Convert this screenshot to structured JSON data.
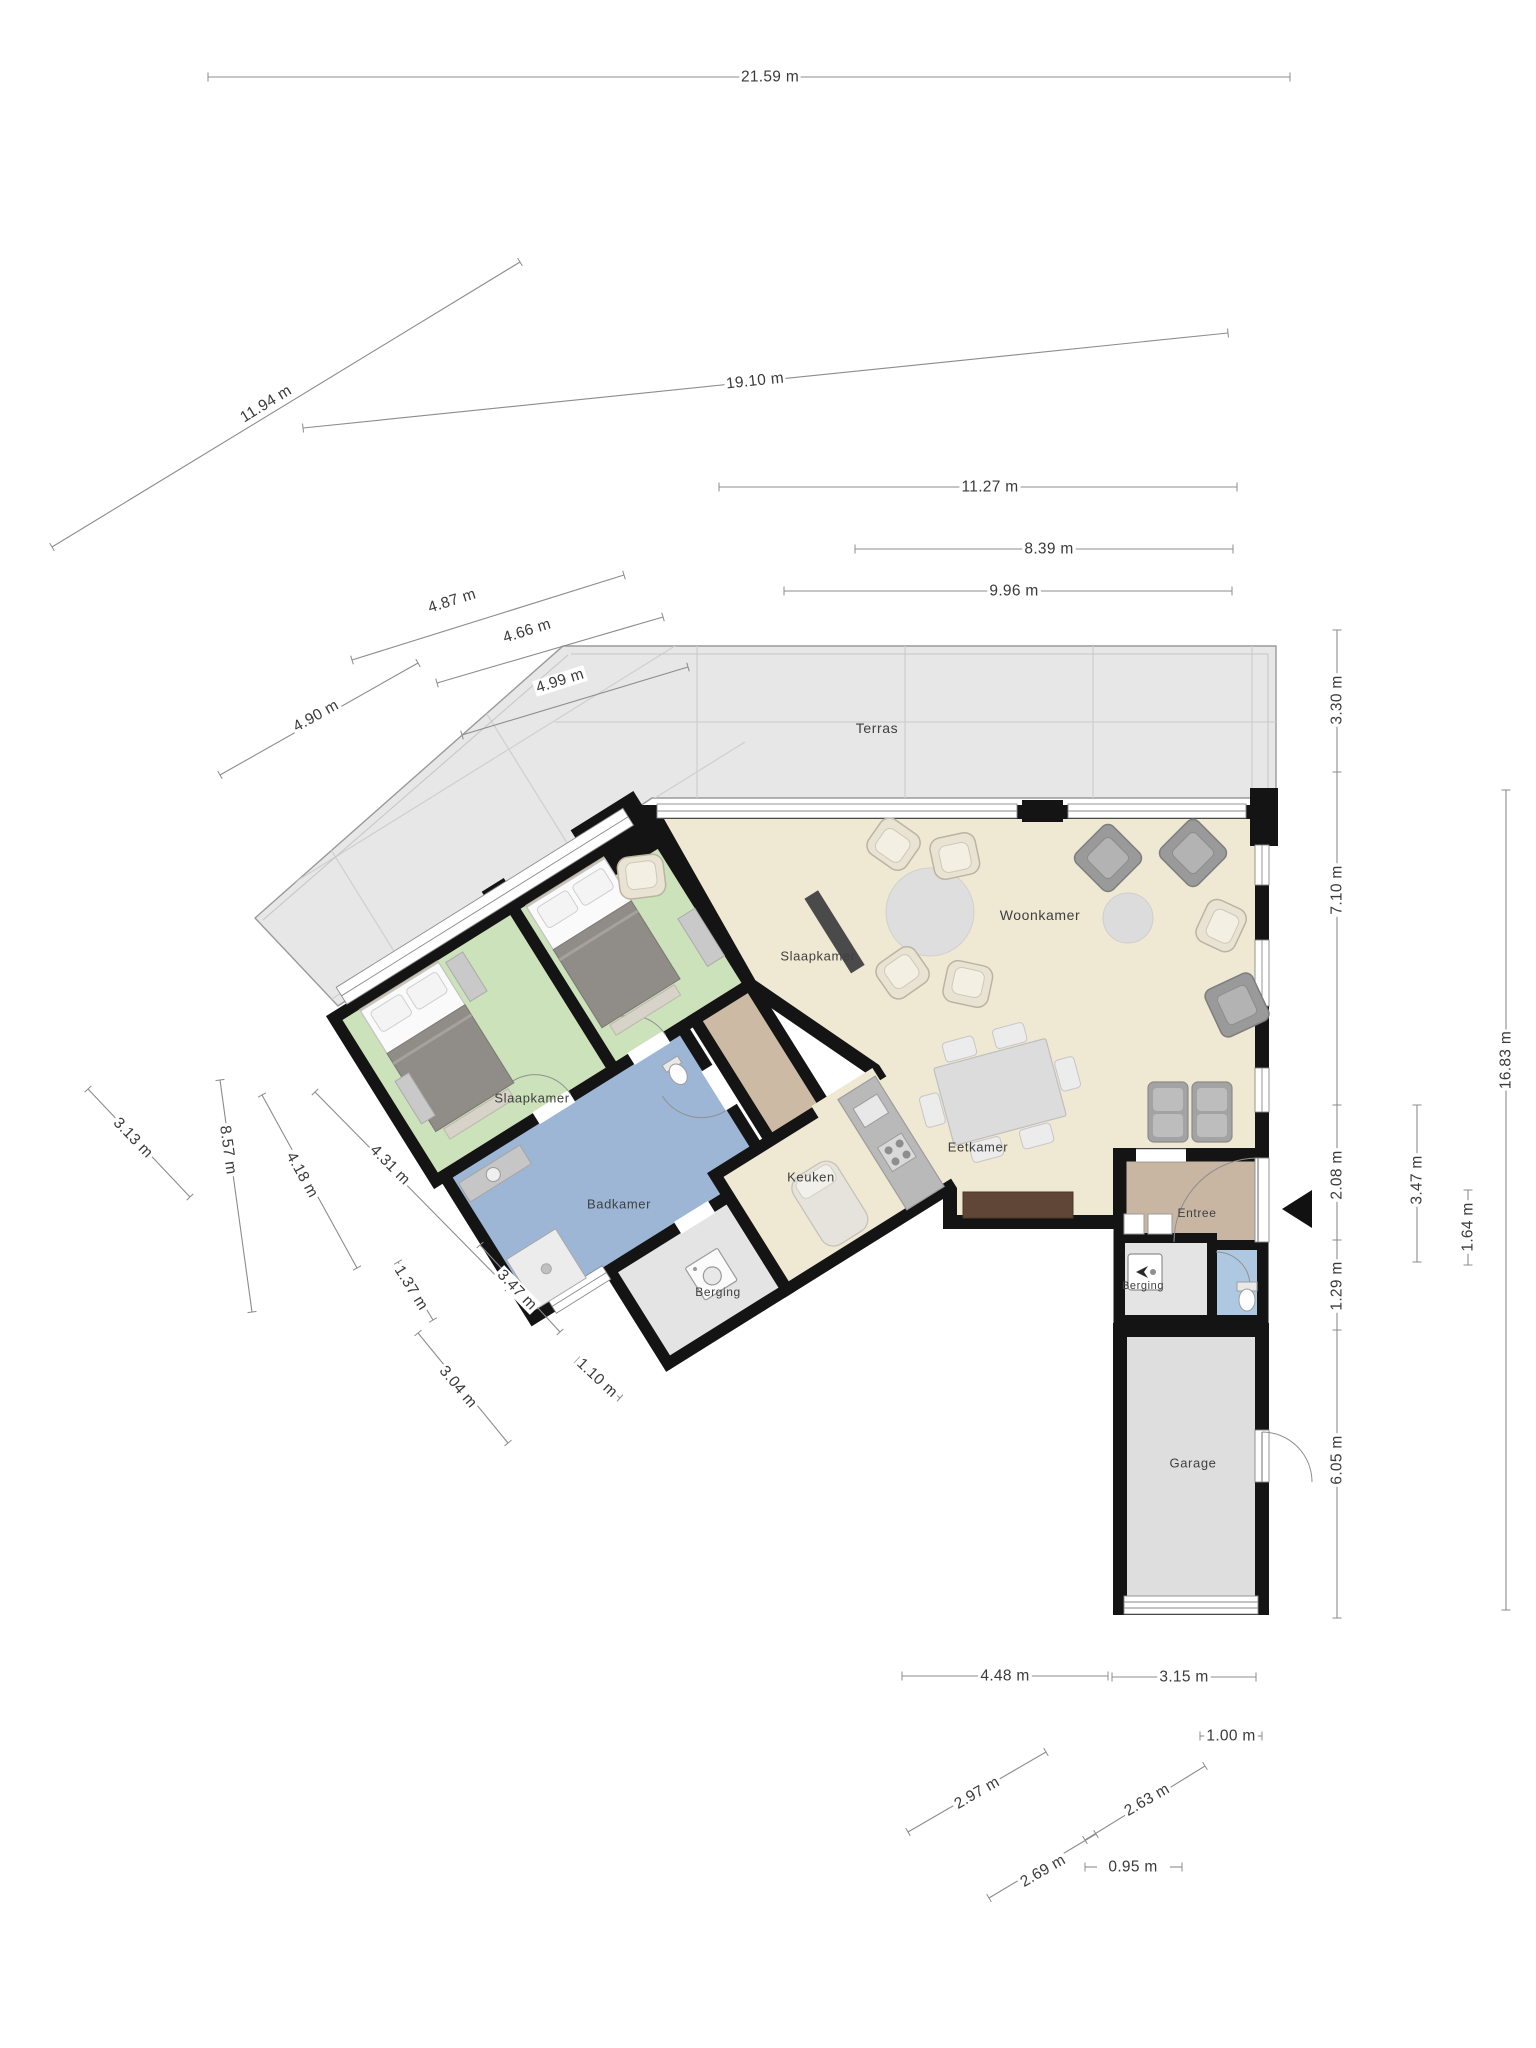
{
  "title": "Plattegrond begane grond",
  "unit": "m",
  "palette": {
    "wall": "#141414",
    "floor_living": "#efe8d3",
    "floor_bedroom": "#cbe2ba",
    "floor_bathroom": "#9db6d6",
    "floor_wc": "#afc8e2",
    "floor_hall": "#cdbaa4",
    "floor_storage": "#e4e4e4",
    "floor_garage": "#dedede",
    "floor_terrace": "#e7e7e7",
    "terrace_grid": "#cfcfcf",
    "window": "#8a8a8a",
    "dimension_line": "#8c8c8c",
    "dimension_text": "#3a3a3a",
    "furniture_dark": "#8f8b87",
    "sideboard_brown": "#5f4636"
  },
  "icons": [
    {
      "name": "entrance-arrow",
      "meaning": "main entrance direction marker"
    },
    {
      "name": "door-swing-arc",
      "meaning": "door opening direction"
    },
    {
      "name": "boiler-icon",
      "meaning": "boiler in storage room"
    },
    {
      "name": "washing-machine-icon",
      "meaning": "washer in storage room"
    }
  ],
  "rooms": [
    {
      "id": "terras",
      "label": "Terras",
      "x": 877,
      "y": 728,
      "size": 14
    },
    {
      "id": "woonkamer",
      "label": "Woonkamer",
      "x": 1040,
      "y": 915,
      "size": 14
    },
    {
      "id": "slaapkamer-2",
      "label": "Slaapkamer",
      "x": 818,
      "y": 956,
      "size": 13
    },
    {
      "id": "slaapkamer-1",
      "label": "Slaapkamer",
      "x": 532,
      "y": 1098,
      "size": 13
    },
    {
      "id": "badkamer",
      "label": "Badkamer",
      "x": 619,
      "y": 1204,
      "size": 13
    },
    {
      "id": "keuken",
      "label": "Keuken",
      "x": 811,
      "y": 1177,
      "size": 13
    },
    {
      "id": "eetkamer",
      "label": "Eetkamer",
      "x": 978,
      "y": 1147,
      "size": 13
    },
    {
      "id": "berging-links",
      "label": "Berging",
      "x": 718,
      "y": 1292,
      "size": 12
    },
    {
      "id": "entree",
      "label": "Entree",
      "x": 1197,
      "y": 1213,
      "size": 12
    },
    {
      "id": "berging-rechts",
      "label": "Berging",
      "x": 1143,
      "y": 1286,
      "size": 11
    },
    {
      "id": "garage",
      "label": "Garage",
      "x": 1193,
      "y": 1463,
      "size": 13
    }
  ],
  "dimensions": [
    {
      "label": "21.59 m",
      "x1": 208,
      "y1": 77,
      "x2": 1290,
      "y2": 77,
      "lx": 770,
      "ly": 77,
      "angle": 0
    },
    {
      "label": "11.94 m",
      "x1": 52,
      "y1": 547,
      "x2": 520,
      "y2": 262,
      "lx": 266,
      "ly": 404,
      "angle": -31.5
    },
    {
      "label": "19.10 m",
      "x1": 303,
      "y1": 428,
      "x2": 1228,
      "y2": 333,
      "lx": 755,
      "ly": 381,
      "angle": -6
    },
    {
      "label": "11.27 m",
      "x1": 719,
      "y1": 487,
      "x2": 1237,
      "y2": 487,
      "lx": 990,
      "ly": 487,
      "angle": 0
    },
    {
      "label": "8.39 m",
      "x1": 855,
      "y1": 549,
      "x2": 1233,
      "y2": 549,
      "lx": 1049,
      "ly": 549,
      "angle": 0
    },
    {
      "label": "9.96 m",
      "x1": 784,
      "y1": 591,
      "x2": 1232,
      "y2": 591,
      "lx": 1014,
      "ly": 591,
      "angle": 0
    },
    {
      "label": "4.87 m",
      "x1": 352,
      "y1": 660,
      "x2": 624,
      "y2": 575,
      "lx": 452,
      "ly": 601,
      "angle": -17.5
    },
    {
      "label": "4.66 m",
      "x1": 437,
      "y1": 683,
      "x2": 663,
      "y2": 617,
      "lx": 527,
      "ly": 631,
      "angle": -17.5
    },
    {
      "label": "4.99 m",
      "x1": 462,
      "y1": 735,
      "x2": 688,
      "y2": 667,
      "lx": 560,
      "ly": 681,
      "angle": -17.5
    },
    {
      "label": "4.90 m",
      "x1": 220,
      "y1": 775,
      "x2": 418,
      "y2": 663,
      "lx": 316,
      "ly": 716,
      "angle": -29
    },
    {
      "label": "3.30 m",
      "x1": 1337,
      "y1": 630,
      "x2": 1337,
      "y2": 772,
      "lx": 1337,
      "ly": 700,
      "angle": -90
    },
    {
      "label": "7.10 m",
      "x1": 1337,
      "y1": 772,
      "x2": 1337,
      "y2": 1105,
      "lx": 1337,
      "ly": 890,
      "angle": -90
    },
    {
      "label": "2.08 m",
      "x1": 1337,
      "y1": 1105,
      "x2": 1337,
      "y2": 1240,
      "lx": 1337,
      "ly": 1175,
      "angle": -90
    },
    {
      "label": "1.29 m",
      "x1": 1337,
      "y1": 1240,
      "x2": 1337,
      "y2": 1330,
      "lx": 1337,
      "ly": 1286,
      "angle": -90
    },
    {
      "label": "6.05 m",
      "x1": 1337,
      "y1": 1330,
      "x2": 1337,
      "y2": 1618,
      "lx": 1337,
      "ly": 1460,
      "angle": -90
    },
    {
      "label": "3.47 m",
      "x1": 1417,
      "y1": 1105,
      "x2": 1417,
      "y2": 1262,
      "lx": 1417,
      "ly": 1180,
      "angle": -90
    },
    {
      "label": "1.64 m",
      "x1": 1468,
      "y1": 1190,
      "x2": 1468,
      "y2": 1265,
      "lx": 1468,
      "ly": 1227,
      "angle": -90
    },
    {
      "label": "16.83 m",
      "x1": 1506,
      "y1": 790,
      "x2": 1506,
      "y2": 1610,
      "lx": 1506,
      "ly": 1060,
      "angle": -90
    },
    {
      "label": "4.48 m",
      "x1": 902,
      "y1": 1676,
      "x2": 1108,
      "y2": 1676,
      "lx": 1005,
      "ly": 1676,
      "angle": 0
    },
    {
      "label": "3.15 m",
      "x1": 1112,
      "y1": 1677,
      "x2": 1256,
      "y2": 1677,
      "lx": 1184,
      "ly": 1677,
      "angle": 0
    },
    {
      "label": "1.00 m",
      "x1": 1200,
      "y1": 1736,
      "x2": 1212,
      "y2": 1736,
      "lx": 1231,
      "ly": 1736,
      "angle": 0,
      "stub2": [
        1250,
        1736,
        1262,
        1736
      ]
    },
    {
      "label": "2.97 m",
      "x1": 908,
      "y1": 1832,
      "x2": 1046,
      "y2": 1752,
      "lx": 977,
      "ly": 1793,
      "angle": -30
    },
    {
      "label": "2.63 m",
      "x1": 1085,
      "y1": 1840,
      "x2": 1205,
      "y2": 1766,
      "lx": 1147,
      "ly": 1800,
      "angle": -30
    },
    {
      "label": "2.69 m",
      "x1": 989,
      "y1": 1898,
      "x2": 1096,
      "y2": 1834,
      "lx": 1043,
      "ly": 1871,
      "angle": -30
    },
    {
      "label": "0.95 m",
      "x1": 1085,
      "y1": 1867,
      "x2": 1097,
      "y2": 1867,
      "lx": 1133,
      "ly": 1867,
      "angle": 0,
      "stub2": [
        1170,
        1867,
        1182,
        1867
      ]
    },
    {
      "label": "3.13 m",
      "x1": 88,
      "y1": 1089,
      "x2": 190,
      "y2": 1197,
      "lx": 133,
      "ly": 1138,
      "angle": 46
    },
    {
      "label": "8.57 m",
      "x1": 220,
      "y1": 1080,
      "x2": 252,
      "y2": 1312,
      "lx": 228,
      "ly": 1150,
      "angle": 82
    },
    {
      "label": "4.18 m",
      "x1": 262,
      "y1": 1095,
      "x2": 357,
      "y2": 1268,
      "lx": 302,
      "ly": 1175,
      "angle": 61
    },
    {
      "label": "4.31 m",
      "x1": 315,
      "y1": 1092,
      "x2": 508,
      "y2": 1288,
      "lx": 390,
      "ly": 1165,
      "angle": 45
    },
    {
      "label": "1.37 m",
      "x1": 398,
      "y1": 1262,
      "x2": 433,
      "y2": 1320,
      "lx": 411,
      "ly": 1288,
      "angle": 58
    },
    {
      "label": "3.47 m",
      "x1": 480,
      "y1": 1245,
      "x2": 560,
      "y2": 1332,
      "lx": 517,
      "ly": 1290,
      "angle": 46
    },
    {
      "label": "3.04 m",
      "x1": 418,
      "y1": 1333,
      "x2": 508,
      "y2": 1443,
      "lx": 458,
      "ly": 1387,
      "angle": 50
    },
    {
      "label": "1.10 m",
      "x1": 577,
      "y1": 1360,
      "x2": 620,
      "y2": 1398,
      "lx": 597,
      "ly": 1378,
      "angle": 43
    }
  ]
}
